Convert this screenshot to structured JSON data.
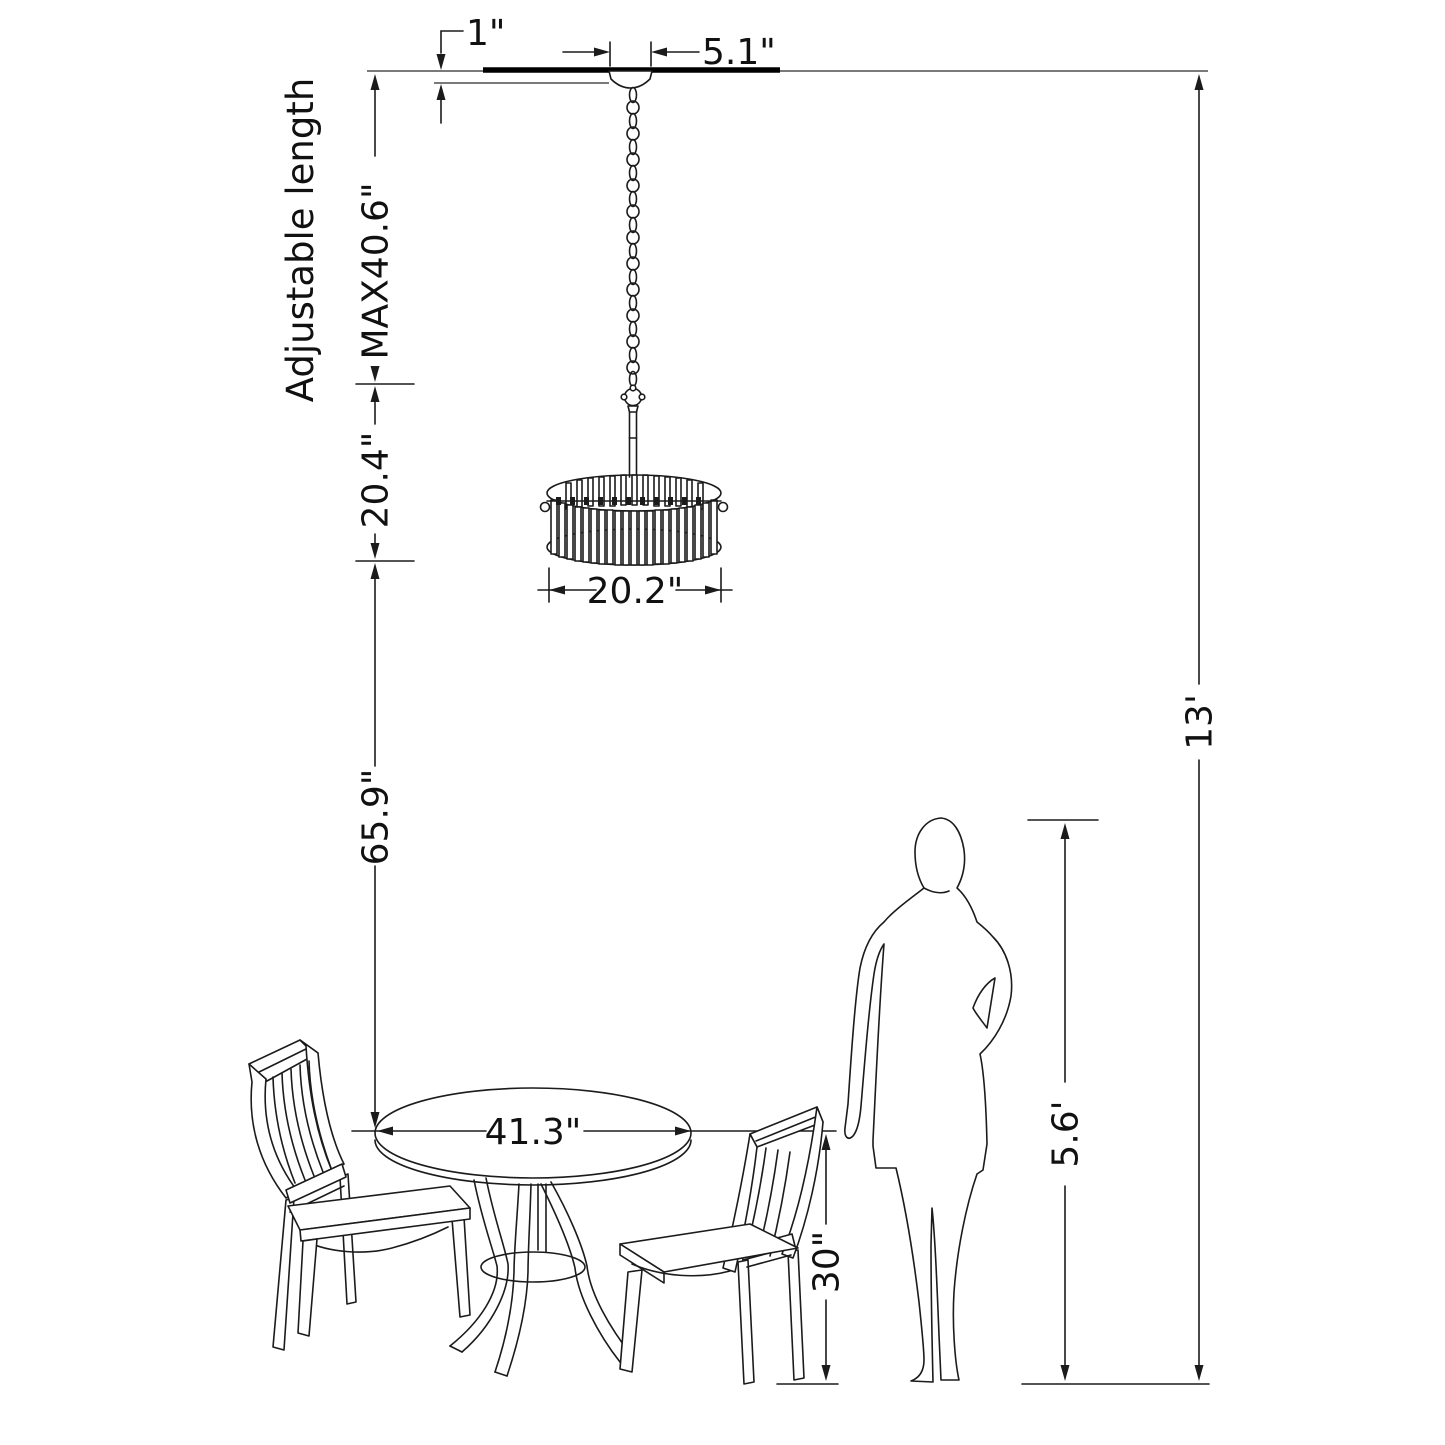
{
  "diagram": {
    "subject": "drum-chandelier hanging above round dining table with two chairs and standing person, with installation dimensions",
    "colors": {
      "background": "#ffffff",
      "line": "#1b1b1b"
    },
    "labels": {
      "canopy_drop": "1\"",
      "canopy_width": "5.1\"",
      "adjustable_note": "Adjustable length",
      "chain_max_length": "MAX40.6\"",
      "fixture_body_height": "20.4\"",
      "shade_diameter": "20.2\"",
      "shade_to_table": "65.9\"",
      "ceiling_height": "13'",
      "person_height": "5.6'",
      "table_height": "30\"",
      "table_diameter": "41.3\""
    }
  }
}
